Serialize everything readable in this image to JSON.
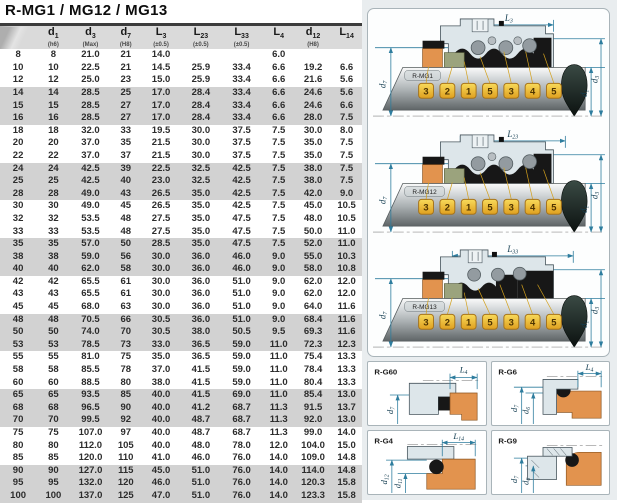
{
  "title": "R-MG1 / MG12 / MG13",
  "table": {
    "headers": [
      {
        "base": "",
        "sub": "",
        "note": ""
      },
      {
        "base": "d",
        "sub": "1",
        "note": "(h6)"
      },
      {
        "base": "d",
        "sub": "3",
        "note": "(Max)"
      },
      {
        "base": "d",
        "sub": "7",
        "note": "(H8)"
      },
      {
        "base": "L",
        "sub": "3",
        "note": "(±0.5)"
      },
      {
        "base": "L",
        "sub": "23",
        "note": "(±0.5)"
      },
      {
        "base": "L",
        "sub": "33",
        "note": "(±0.5)"
      },
      {
        "base": "L",
        "sub": "4",
        "note": ""
      },
      {
        "base": "d",
        "sub": "12",
        "note": "(H8)"
      },
      {
        "base": "L",
        "sub": "14",
        "note": ""
      }
    ],
    "rows": [
      [
        "8",
        "8",
        "21.0",
        "21",
        "14.0",
        "",
        "",
        "6.0",
        "",
        ""
      ],
      [
        "10",
        "10",
        "22.5",
        "21",
        "14.5",
        "25.9",
        "33.4",
        "6.6",
        "19.2",
        "6.6"
      ],
      [
        "12",
        "12",
        "25.0",
        "23",
        "15.0",
        "25.9",
        "33.4",
        "6.6",
        "21.6",
        "5.6"
      ],
      [
        "14",
        "14",
        "28.5",
        "25",
        "17.0",
        "28.4",
        "33.4",
        "6.6",
        "24.6",
        "5.6"
      ],
      [
        "15",
        "15",
        "28.5",
        "27",
        "17.0",
        "28.4",
        "33.4",
        "6.6",
        "24.6",
        "6.6"
      ],
      [
        "16",
        "16",
        "28.5",
        "27",
        "17.0",
        "28.4",
        "33.4",
        "6.6",
        "28.0",
        "7.5"
      ],
      [
        "18",
        "18",
        "32.0",
        "33",
        "19.5",
        "30.0",
        "37.5",
        "7.5",
        "30.0",
        "8.0"
      ],
      [
        "20",
        "20",
        "37.0",
        "35",
        "21.5",
        "30.0",
        "37.5",
        "7.5",
        "35.0",
        "7.5"
      ],
      [
        "22",
        "22",
        "37.0",
        "37",
        "21.5",
        "30.0",
        "37.5",
        "7.5",
        "35.0",
        "7.5"
      ],
      [
        "24",
        "24",
        "42.5",
        "39",
        "22.5",
        "32.5",
        "42.5",
        "7.5",
        "38.0",
        "7.5"
      ],
      [
        "25",
        "25",
        "42.5",
        "40",
        "23.0",
        "32.5",
        "42.5",
        "7.5",
        "38.0",
        "7.5"
      ],
      [
        "28",
        "28",
        "49.0",
        "43",
        "26.5",
        "35.0",
        "42.5",
        "7.5",
        "42.0",
        "9.0"
      ],
      [
        "30",
        "30",
        "49.0",
        "45",
        "26.5",
        "35.0",
        "42.5",
        "7.5",
        "45.0",
        "10.5"
      ],
      [
        "32",
        "32",
        "53.5",
        "48",
        "27.5",
        "35.0",
        "47.5",
        "7.5",
        "48.0",
        "10.5"
      ],
      [
        "33",
        "33",
        "53.5",
        "48",
        "27.5",
        "35.0",
        "47.5",
        "7.5",
        "50.0",
        "11.0"
      ],
      [
        "35",
        "35",
        "57.0",
        "50",
        "28.5",
        "35.0",
        "47.5",
        "7.5",
        "52.0",
        "11.0"
      ],
      [
        "38",
        "38",
        "59.0",
        "56",
        "30.0",
        "36.0",
        "46.0",
        "9.0",
        "55.0",
        "10.3"
      ],
      [
        "40",
        "40",
        "62.0",
        "58",
        "30.0",
        "36.0",
        "46.0",
        "9.0",
        "58.0",
        "10.8"
      ],
      [
        "42",
        "42",
        "65.5",
        "61",
        "30.0",
        "36.0",
        "51.0",
        "9.0",
        "62.0",
        "12.0"
      ],
      [
        "43",
        "43",
        "65.5",
        "61",
        "30.0",
        "36.0",
        "51.0",
        "9.0",
        "62.0",
        "12.0"
      ],
      [
        "45",
        "45",
        "68.0",
        "63",
        "30.0",
        "36.0",
        "51.0",
        "9.0",
        "64.0",
        "11.6"
      ],
      [
        "48",
        "48",
        "70.5",
        "66",
        "30.5",
        "36.0",
        "51.0",
        "9.0",
        "68.4",
        "11.6"
      ],
      [
        "50",
        "50",
        "74.0",
        "70",
        "30.5",
        "38.0",
        "50.5",
        "9.5",
        "69.3",
        "11.6"
      ],
      [
        "53",
        "53",
        "78.5",
        "73",
        "33.0",
        "36.5",
        "59.0",
        "11.0",
        "72.3",
        "12.3"
      ],
      [
        "55",
        "55",
        "81.0",
        "75",
        "35.0",
        "36.5",
        "59.0",
        "11.0",
        "75.4",
        "13.3"
      ],
      [
        "58",
        "58",
        "85.5",
        "78",
        "37.0",
        "41.5",
        "59.0",
        "11.0",
        "78.4",
        "13.3"
      ],
      [
        "60",
        "60",
        "88.5",
        "80",
        "38.0",
        "41.5",
        "59.0",
        "11.0",
        "80.4",
        "13.3"
      ],
      [
        "65",
        "65",
        "93.5",
        "85",
        "40.0",
        "41.5",
        "69.0",
        "11.0",
        "85.4",
        "13.0"
      ],
      [
        "68",
        "68",
        "96.5",
        "90",
        "40.0",
        "41.2",
        "68.7",
        "11.3",
        "91.5",
        "13.7"
      ],
      [
        "70",
        "70",
        "99.5",
        "92",
        "40.0",
        "48.7",
        "68.7",
        "11.3",
        "92.0",
        "13.0"
      ],
      [
        "75",
        "75",
        "107.0",
        "97",
        "40.0",
        "48.7",
        "68.7",
        "11.3",
        "99.0",
        "14.0"
      ],
      [
        "80",
        "80",
        "112.0",
        "105",
        "40.0",
        "48.0",
        "78.0",
        "12.0",
        "104.0",
        "15.0"
      ],
      [
        "85",
        "85",
        "120.0",
        "110",
        "41.0",
        "46.0",
        "76.0",
        "14.0",
        "109.0",
        "14.8"
      ],
      [
        "90",
        "90",
        "127.0",
        "115",
        "45.0",
        "51.0",
        "76.0",
        "14.0",
        "114.0",
        "14.8"
      ],
      [
        "95",
        "95",
        "132.0",
        "120",
        "46.0",
        "51.0",
        "76.0",
        "14.0",
        "120.3",
        "15.8"
      ],
      [
        "100",
        "100",
        "137.0",
        "125",
        "47.0",
        "51.0",
        "76.0",
        "14.0",
        "123.3",
        "15.8"
      ]
    ]
  },
  "diagrams": [
    {
      "label": "R-MG1",
      "dim_top": {
        "base": "L",
        "sub": "3"
      },
      "dim_left": {
        "base": "d",
        "sub": "7"
      },
      "dim_right_inner": {
        "base": "d",
        "sub": "1"
      },
      "dim_right_outer": {
        "base": "d",
        "sub": "3"
      },
      "badges": [
        "3",
        "2",
        "1",
        "5",
        "3",
        "4",
        "5"
      ]
    },
    {
      "label": "R-MG12",
      "dim_top": {
        "base": "L",
        "sub": "23"
      },
      "dim_left": {
        "base": "d",
        "sub": "7"
      },
      "dim_right_inner": {
        "base": "d",
        "sub": "1"
      },
      "dim_right_outer": {
        "base": "d",
        "sub": "3"
      },
      "badges": [
        "3",
        "2",
        "1",
        "5",
        "3",
        "4",
        "5"
      ]
    },
    {
      "label": "R-MG13",
      "dim_top": {
        "base": "L",
        "sub": "33"
      },
      "dim_left": {
        "base": "d",
        "sub": "7"
      },
      "dim_right_inner": {
        "base": "d",
        "sub": "1"
      },
      "dim_right_outer": {
        "base": "d",
        "sub": "3"
      },
      "badges": [
        "3",
        "2",
        "1",
        "5",
        "3",
        "4",
        "5"
      ]
    }
  ],
  "panels": [
    {
      "label": "R-G60",
      "dim_top": {
        "base": "L",
        "sub": "4"
      },
      "dims_left": [
        {
          "base": "d",
          "sub": "7"
        }
      ]
    },
    {
      "label": "R-G6",
      "dim_top": {
        "base": "L",
        "sub": "4"
      },
      "dims_left": [
        {
          "base": "d",
          "sub": "7"
        },
        {
          "base": "d",
          "sub": "6"
        }
      ]
    },
    {
      "label": "R-G4",
      "dim_top": {
        "base": "L",
        "sub": "14"
      },
      "dims_left": [
        {
          "base": "d",
          "sub": "12"
        },
        {
          "base": "d",
          "sub": "11"
        }
      ]
    },
    {
      "label": "R-G9",
      "dims_left": [
        {
          "base": "d",
          "sub": "7"
        },
        {
          "base": "d",
          "sub": "6"
        }
      ]
    }
  ],
  "colors": {
    "dimension_line": "#2e7d9e",
    "badge_gold": "#e8b42a",
    "seat_orange": "#e2934e",
    "ring_olive": "#9ba37d",
    "elastomer_black": "#171717",
    "band_gray": "#d2d2d2",
    "header_gray": "#dadada"
  }
}
